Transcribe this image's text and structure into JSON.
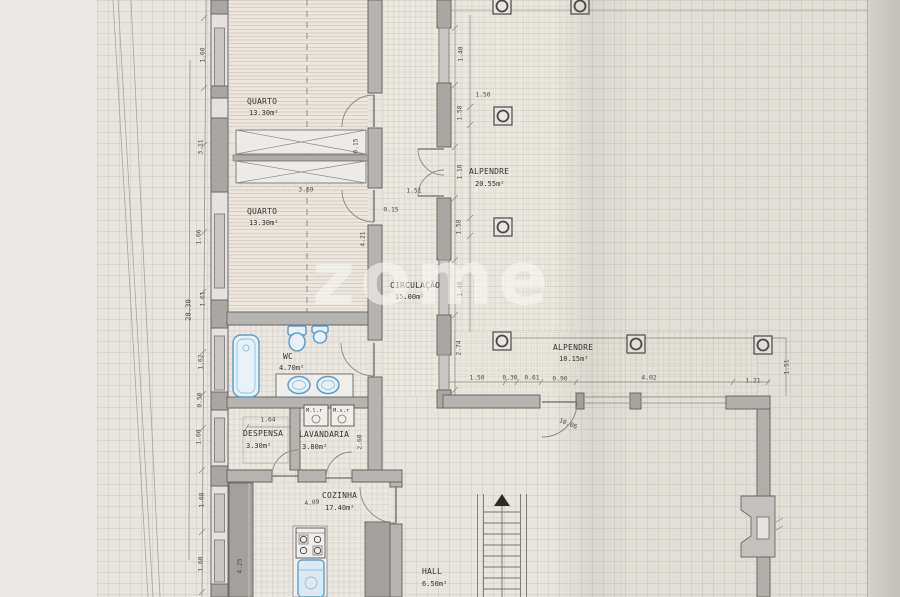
{
  "watermark": {
    "text": "zome"
  },
  "colors": {
    "paper": "#e8e5df",
    "paper_margin": "#eae8e4",
    "grid": "rgba(178,166,140,0.24)",
    "wall_dark": "#a9a7a3",
    "wall_mid": "#b6b4b0",
    "wall_light": "#e4e2de",
    "window_fill": "#c9c7c3",
    "outline": "#6b6965",
    "line": "#8a8783",
    "fixture_blue": "#5b9fd0",
    "fixture_fill": "#e8f1f8",
    "counter": "#a3a19d",
    "text": "#34322f",
    "dim_text": "#4e4c48",
    "watermark": "rgba(247,246,243,0.6)",
    "page_edge": "#c8c5c0"
  },
  "rooms": [
    {
      "id": "quarto-1",
      "name": "QUARTO",
      "area": "13.30m²",
      "nx": 247,
      "ny": 97,
      "ax": 249,
      "ay": 109
    },
    {
      "id": "quarto-2",
      "name": "QUARTO",
      "area": "13.30m²",
      "nx": 247,
      "ny": 207,
      "ax": 249,
      "ay": 219
    },
    {
      "id": "wc",
      "name": "WC",
      "area": "4.70m²",
      "nx": 283,
      "ny": 352,
      "ax": 279,
      "ay": 364
    },
    {
      "id": "despensa",
      "name": "DESPENSA",
      "area": "3.30m²",
      "nx": 243,
      "ny": 429,
      "ax": 246,
      "ay": 442
    },
    {
      "id": "lavandaria",
      "name": "LAVANDARIA",
      "area": "3.80m²",
      "nx": 299,
      "ny": 430,
      "ax": 302,
      "ay": 443
    },
    {
      "id": "cozinha",
      "name": "COZINHA",
      "area": "17.40m²",
      "nx": 322,
      "ny": 491,
      "ax": 325,
      "ay": 504
    },
    {
      "id": "circulacao",
      "name": "CIRCULAÇÃO",
      "area": "15.00m²",
      "nx": 390,
      "ny": 281,
      "ax": 395,
      "ay": 293
    },
    {
      "id": "alpendre-1",
      "name": "ALPENDRE",
      "area": "20.55m²",
      "nx": 469,
      "ny": 167,
      "ax": 475,
      "ay": 180
    },
    {
      "id": "alpendre-2",
      "name": "ALPENDRE",
      "area": "10.15m²",
      "nx": 553,
      "ny": 343,
      "ax": 559,
      "ay": 355
    },
    {
      "id": "hall",
      "name": "HALL",
      "area": "6.50m²",
      "nx": 422,
      "ny": 567,
      "ax": 422,
      "ay": 580
    }
  ],
  "appliances": [
    {
      "label": "M.l.r",
      "x": 306,
      "y": 408
    },
    {
      "label": "M.s.r",
      "x": 333,
      "y": 408
    }
  ],
  "dimensions": [
    {
      "t": "1.60",
      "x": 203,
      "y": 55,
      "rot": -90
    },
    {
      "t": "3.11",
      "x": 201,
      "y": 147,
      "rot": -90
    },
    {
      "t": "1.66",
      "x": 199,
      "y": 237,
      "rot": -90
    },
    {
      "t": "28.30",
      "x": 188,
      "y": 310,
      "rot": -90,
      "lg": true
    },
    {
      "t": "1.61",
      "x": 203,
      "y": 299,
      "rot": -90
    },
    {
      "t": "1.62",
      "x": 201,
      "y": 362,
      "rot": -90
    },
    {
      "t": "0.50",
      "x": 200,
      "y": 400,
      "rot": -90
    },
    {
      "t": "1.60",
      "x": 199,
      "y": 437,
      "rot": -90
    },
    {
      "t": "1.68",
      "x": 202,
      "y": 500,
      "rot": -90
    },
    {
      "t": "1.60",
      "x": 201,
      "y": 564,
      "rot": -90
    },
    {
      "t": "4.25",
      "x": 240,
      "y": 566,
      "rot": -90
    },
    {
      "t": "1.64",
      "x": 268,
      "y": 420,
      "rot": 0
    },
    {
      "t": "2.60",
      "x": 360,
      "y": 442,
      "rot": -90
    },
    {
      "t": "4.09",
      "x": 312,
      "y": 503,
      "rot": -6
    },
    {
      "t": "3.69",
      "x": 306,
      "y": 190,
      "rot": 0
    },
    {
      "t": "0.15",
      "x": 391,
      "y": 210,
      "rot": 0
    },
    {
      "t": "1.51",
      "x": 414,
      "y": 191,
      "rot": 0
    },
    {
      "t": "4.21",
      "x": 363,
      "y": 239,
      "rot": -90
    },
    {
      "t": "0.15",
      "x": 356,
      "y": 146,
      "rot": -90
    },
    {
      "t": "1.40",
      "x": 461,
      "y": 54,
      "rot": -90
    },
    {
      "t": "1.58",
      "x": 460,
      "y": 113,
      "rot": -90
    },
    {
      "t": "1.10",
      "x": 460,
      "y": 172,
      "rot": -90
    },
    {
      "t": "1.58",
      "x": 459,
      "y": 227,
      "rot": -90
    },
    {
      "t": "1.40",
      "x": 460,
      "y": 289,
      "rot": -90
    },
    {
      "t": "2.74",
      "x": 459,
      "y": 348,
      "rot": -90
    },
    {
      "t": "1.50",
      "x": 483,
      "y": 95,
      "rot": 0
    },
    {
      "t": "1.50",
      "x": 477,
      "y": 378,
      "rot": 0
    },
    {
      "t": "0.30",
      "x": 510,
      "y": 378,
      "rot": 0
    },
    {
      "t": "0.61",
      "x": 532,
      "y": 378,
      "rot": 0
    },
    {
      "t": "0.90",
      "x": 560,
      "y": 379,
      "rot": 0
    },
    {
      "t": "4.02",
      "x": 649,
      "y": 378,
      "rot": 0
    },
    {
      "t": "1.21",
      "x": 753,
      "y": 381,
      "rot": 0
    },
    {
      "t": "1.51",
      "x": 787,
      "y": 367,
      "rot": -90
    },
    {
      "t": "10.06",
      "x": 568,
      "y": 424,
      "rot": 22
    }
  ]
}
